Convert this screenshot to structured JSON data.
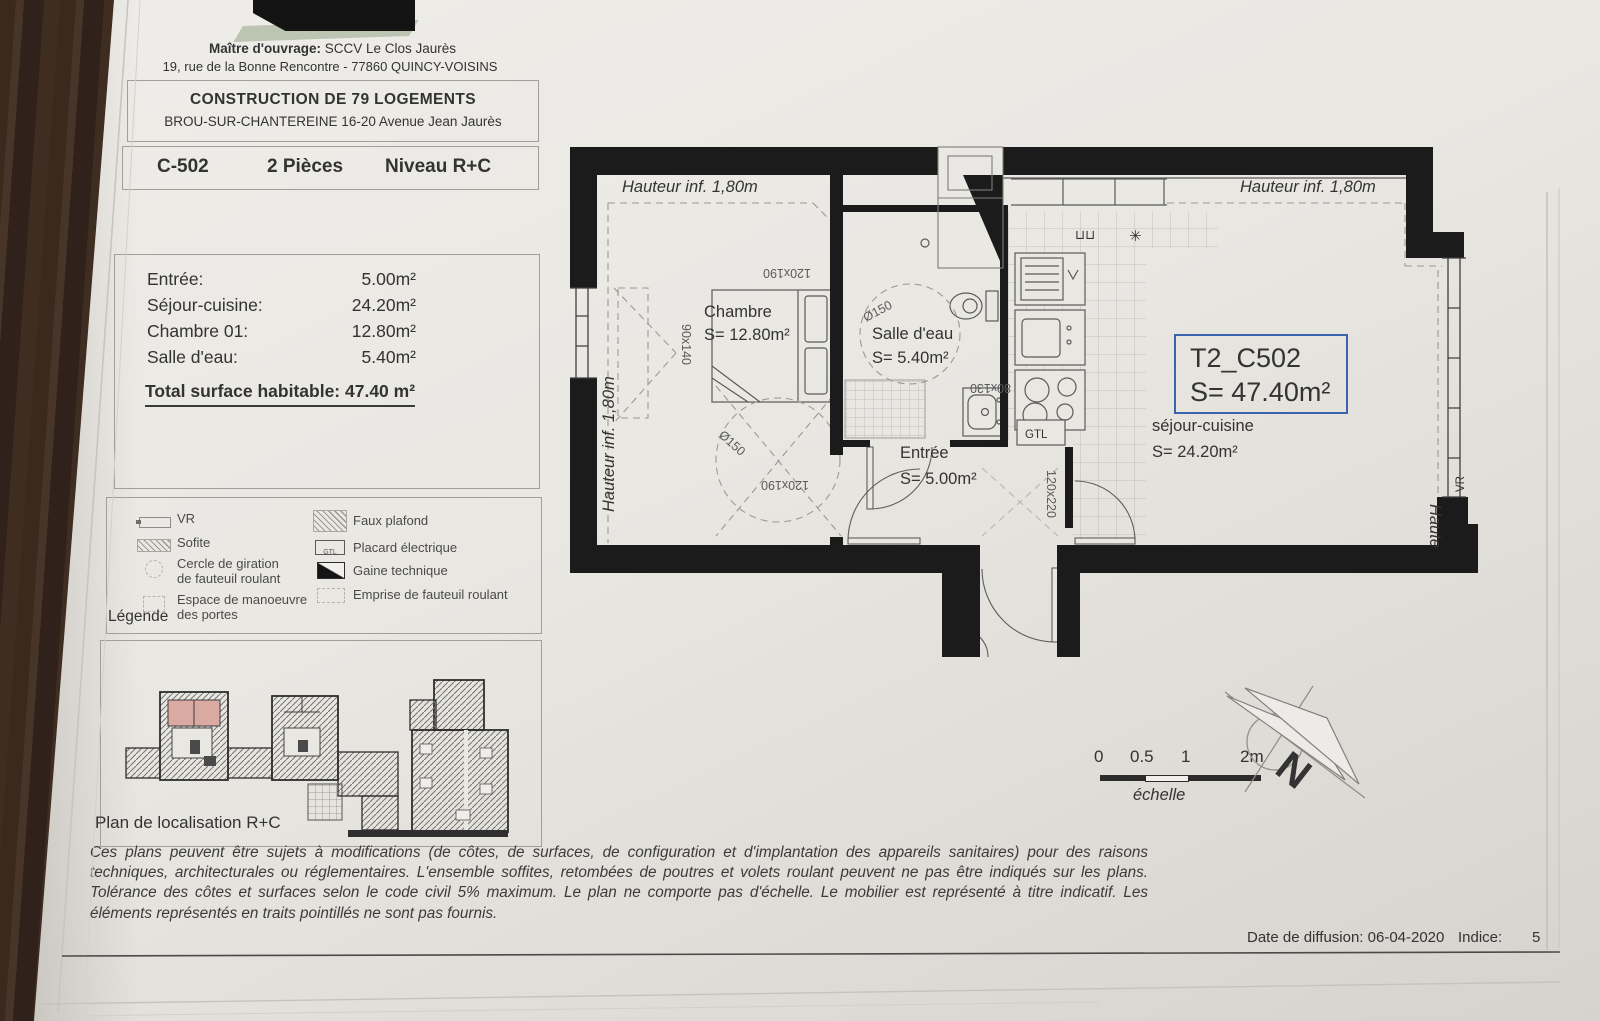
{
  "header": {
    "owner_label": "Maître d'ouvrage:",
    "owner_name": " SCCV Le Clos Jaurès",
    "owner_address": "19, rue de la Bonne Rencontre - 77860 QUINCY-VOISINS",
    "project_title": "CONSTRUCTION DE 79 LOGEMENTS",
    "project_address": "BROU-SUR-CHANTEREINE  16-20 Avenue Jean Jaurès",
    "unit_ref": "C-502",
    "unit_rooms": "2 Pièces",
    "unit_level": "Niveau R+C"
  },
  "surfaces": {
    "rows": [
      {
        "label": "Entrée:",
        "value": "5.00m²"
      },
      {
        "label": "Séjour-cuisine:",
        "value": "24.20m²"
      },
      {
        "label": "Chambre 01:",
        "value": "12.80m²"
      },
      {
        "label": "Salle d'eau:",
        "value": "5.40m²"
      }
    ],
    "total": "Total surface habitable: 47.40 m²"
  },
  "legend": {
    "title": "Légende",
    "left": [
      {
        "l1": "VR"
      },
      {
        "l1": "Sofite"
      },
      {
        "l1": "Cercle de giration",
        "l2": "de fauteuil roulant"
      },
      {
        "l1": "Espace de manoeuvre",
        "l2": "des portes"
      }
    ],
    "right": [
      {
        "l1": "Faux plafond"
      },
      {
        "l1": "Placard électrique",
        "icon_text": "GTL"
      },
      {
        "l1": "Gaine technique"
      },
      {
        "l1": "Emprise de fauteuil roulant"
      }
    ]
  },
  "location": {
    "caption": "Plan de localisation R+C"
  },
  "plan": {
    "height_note_top_left": "Hauteur inf. 1,80m",
    "height_note_top_right": "Hauteur inf. 1,80m",
    "height_note_left_vertical": "Hauteur inf. 1,80m",
    "height_note_right_partial": "Haute",
    "rooms": {
      "chambre": {
        "name": "Chambre",
        "area": "S= 12.80m²"
      },
      "salle_deau": {
        "name": "Salle d'eau",
        "area": "S= 5.40m²"
      },
      "entree": {
        "name": "Entrée",
        "area": "S= 5.00m²"
      },
      "sejour": {
        "name": "séjour-cuisine",
        "area": "S= 24.20m²"
      }
    },
    "unit_box": {
      "code": "T2_C502",
      "area": "S= 47.40m²"
    },
    "labels": {
      "gtl": "GTL",
      "vr": "VR"
    },
    "dims": {
      "bed_top": "120x190",
      "bed_bottom": "120x190",
      "chambre_window": "90x140",
      "shower": "80x130",
      "entry_door": "120x220",
      "giration_chambre": "Ø150",
      "giration_salle_deau": "Ø150"
    },
    "symbols": {
      "cabinet": "⊔⊔",
      "vent": "✳"
    }
  },
  "scale_bar": {
    "ticks": [
      "0",
      "0.5",
      "1",
      "2m"
    ],
    "caption": "échelle"
  },
  "compass": {
    "letter": "N"
  },
  "disclaimer": "Ces plans peuvent être sujets à modifications (de côtes, de surfaces, de configuration et d'implantation des appareils sanitaires) pour des raisons techniques, architecturales ou réglementaires. L'ensemble soffites, retombées de poutres et volets roulant peuvent ne pas être indiqués sur les plans. Tolérance des côtes et surfaces selon le code civil 5% maximum. Le plan ne comporte pas d'échelle. Le mobilier est représenté à titre indicatif. Les éléments représentés en traits pointillés ne sont pas fournis.",
  "footer": {
    "diffusion": "Date de diffusion: 06-04-2020",
    "indice_label": "Indice:",
    "indice_value": "5"
  },
  "colors": {
    "accent_blue": "#3c63ad",
    "wall_black": "#1b1b1b",
    "paper": "#e9e7e2",
    "highlight_pink": "#d9a9a2"
  }
}
